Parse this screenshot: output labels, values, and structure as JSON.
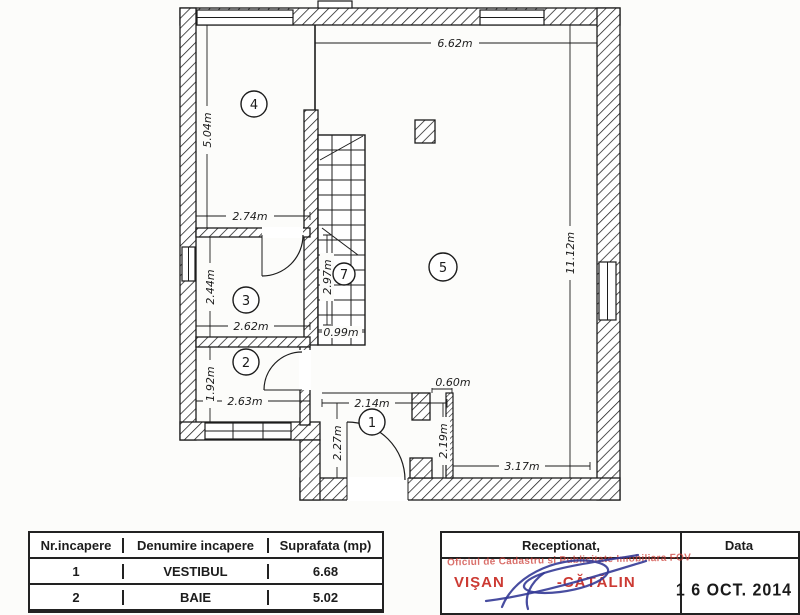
{
  "plan": {
    "dims": {
      "top_width": "6.62m",
      "left_height": "5.04m",
      "room4_width": "2.74m",
      "room3_height": "2.44m",
      "room3_width": "2.62m",
      "room2_height": "1.92m",
      "room2_width": "2.63m",
      "stairs_height": "2.97m",
      "stairs_width": "0.99m",
      "right_height": "11.12m",
      "door_width": "0.60m",
      "room1_width": "2.14m",
      "room1_left_height": "2.27m",
      "room1_right_height": "2.19m",
      "bottom_width": "3.17m"
    },
    "room_numbers": {
      "r1": "1",
      "r2": "2",
      "r3": "3",
      "r4": "4",
      "r5": "5",
      "r7": "7"
    }
  },
  "table": {
    "headers": [
      "Nr.incapere",
      "Denumire incapere",
      "Suprafata (mp)"
    ],
    "rows": [
      {
        "nr": "1",
        "denumire": "VESTIBUL",
        "suprafata": "6.68"
      },
      {
        "nr": "2",
        "denumire": "BAIE",
        "suprafata": "5.02"
      }
    ]
  },
  "reception": {
    "title": "Receptionat,",
    "stamp_office": "Oficiul de Cadastru si Publicitate Imobiliara FOV",
    "stamp_name_left": "VIŞAN",
    "stamp_name_right": "-CĂTĂLIN",
    "date_label": "Data",
    "date_stamp": "1 6 OCT. 2014"
  },
  "colors": {
    "ink": "#1c1c1c",
    "stamp_red": "#cc3a33",
    "signature_blue": "#343a96",
    "paper": "#fcfcfa"
  }
}
